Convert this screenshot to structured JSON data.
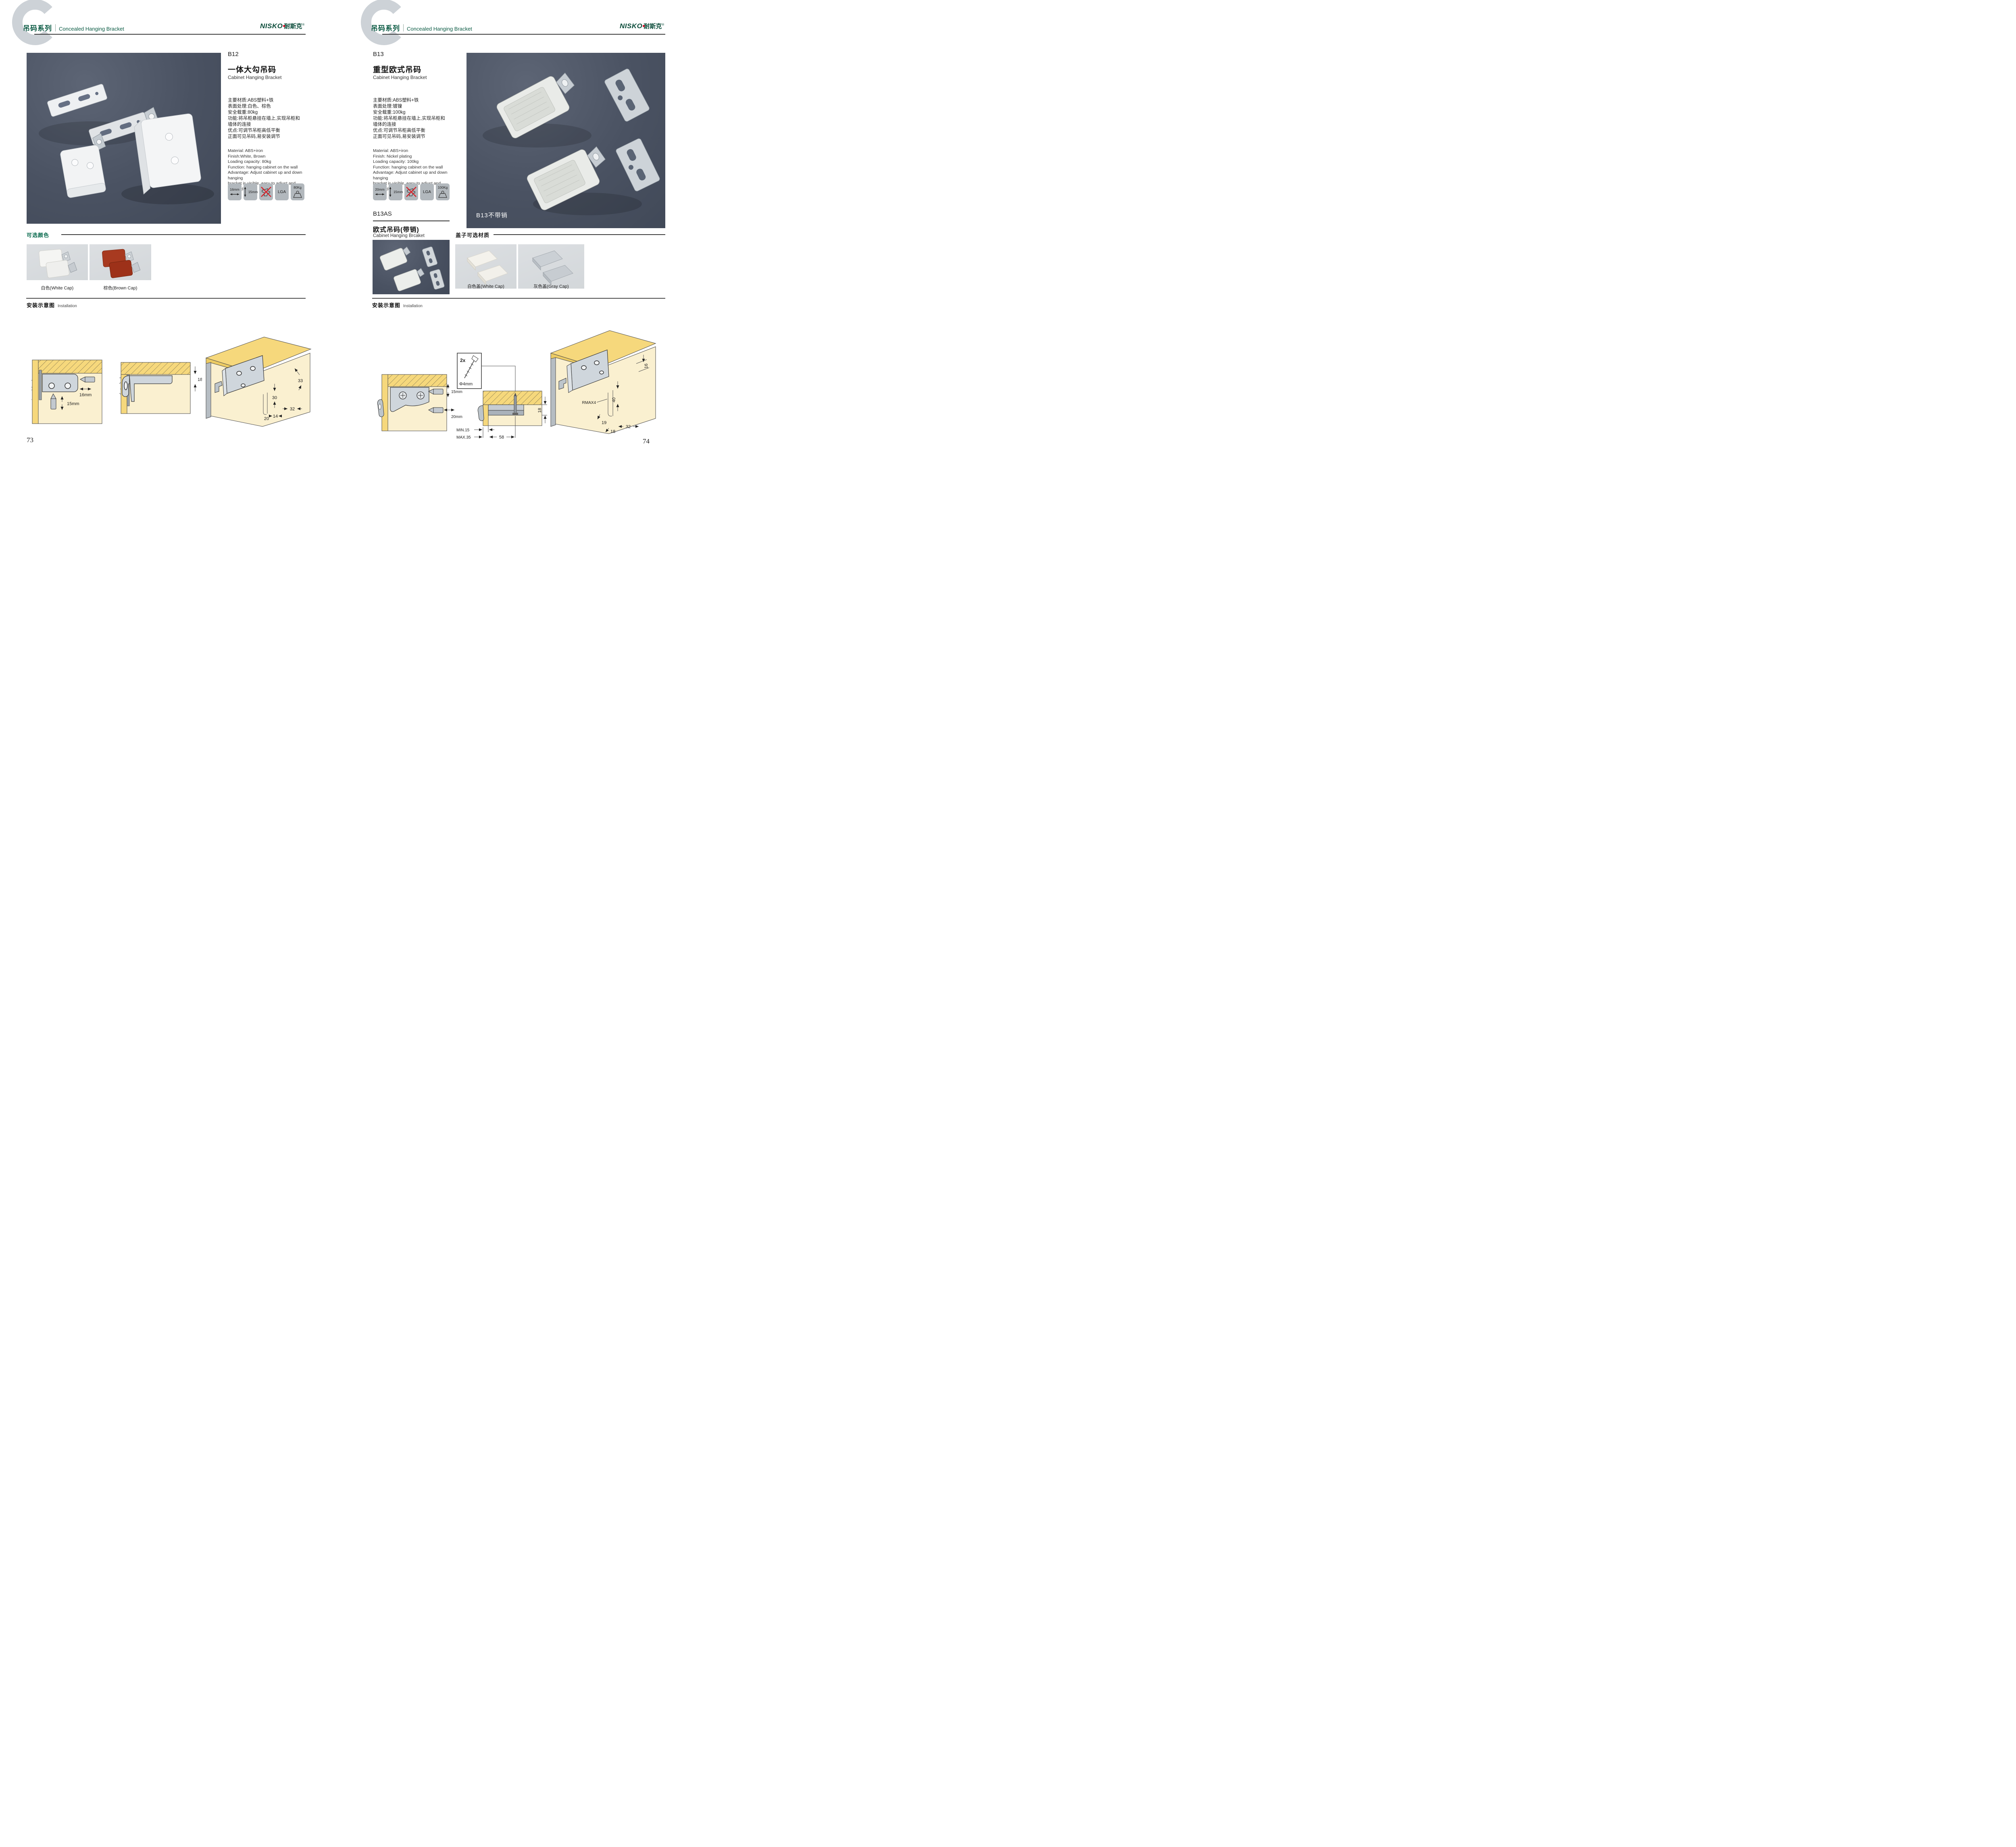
{
  "brand": {
    "latin": "NISKO",
    "cn": "耐斯克",
    "reg": "®"
  },
  "header": {
    "series_cn": "吊码系列",
    "series_en": "Concealed Hanging Bracket"
  },
  "left": {
    "code": "B12",
    "name_cn": "一体大勾吊码",
    "name_en": "Cabinet Hanging Bracket",
    "specs_cn": [
      "主要材质:ABS塑料+铁",
      "表面处理:白色、棕色",
      "安全载重:80kg",
      "功能:将吊柜悬挂在墙上,实现吊柜和",
      "墙体的连接",
      "优点:可调节吊柜高低平衡",
      "正面可见吊码,易安装调节"
    ],
    "specs_en": [
      "Material: ABS+iron",
      "Finish:White, Brown",
      "Loading capacity: 80kg",
      "Function: hanging cabinet on the wall",
      "Advantage: Adjust cabinet up and down hanging",
      "bracket is visible, easy to adjust and installed"
    ],
    "icons": {
      "width": "16mm",
      "height": "15mm",
      "cert": "LGA",
      "load": "80Kg"
    },
    "colors_title": "可选颜色",
    "color_options": [
      "白色(White Cap)",
      "棕色(Brown Cap)"
    ],
    "install_title_cn": "安装示意图",
    "install_title_en": "Installation",
    "d1": {
      "h": "16mm",
      "v": "15mm"
    },
    "d2": {
      "offset": "18"
    },
    "d3": {
      "a": "33",
      "b": "30",
      "c": "32",
      "d": "20",
      "e": "14"
    },
    "page": "73"
  },
  "right": {
    "code": "B13",
    "name_cn": "重型欧式吊码",
    "name_en": "Cabinet Hanging Bracket",
    "specs_cn": [
      "主要材质:ABS塑料+铁",
      "表面处理:镀镍",
      "安全载重:100kg",
      "功能:将吊柜悬挂在墙上,实现吊柜和",
      "墙体的连接",
      "优点:可调节吊柜高低平衡",
      "正面可见吊码,易安装调节"
    ],
    "specs_en": [
      "Material: ABS+iron",
      "Finish: Nickel plating",
      "Loading capacity: 100kg",
      "Function: hanging cabinet on the wall",
      "Advantage: Adjust cabinet up and down hanging",
      "bracket is visible, easy to adjust and installed"
    ],
    "icons": {
      "width": "20mm",
      "height": "15mm",
      "cert": "LGA",
      "load": "100Kg"
    },
    "photo_caption": "B13不带销",
    "sub_code": "B13AS",
    "sub_name_cn": "欧式吊码(带销)",
    "sub_name_en": "Cabinet Hanging Brcaket",
    "caps_title": "盖子可选材质",
    "cap_options": [
      "白色盖(White Cap)",
      "灰色盖(Gray Cap)"
    ],
    "install_title_cn": "安装示意图",
    "install_title_en": "Installation",
    "d1": {
      "v": "15mm",
      "h": "20mm"
    },
    "d2": {
      "qty": "2x",
      "dia": "Φ4mm",
      "offset": "18",
      "min": "MIN.15",
      "max": "MAX.35",
      "w": "58"
    },
    "d3": {
      "t": "16",
      "h": "40",
      "r": "RMAX4",
      "a": "19",
      "b": "18",
      "c": "32"
    },
    "page": "74"
  }
}
